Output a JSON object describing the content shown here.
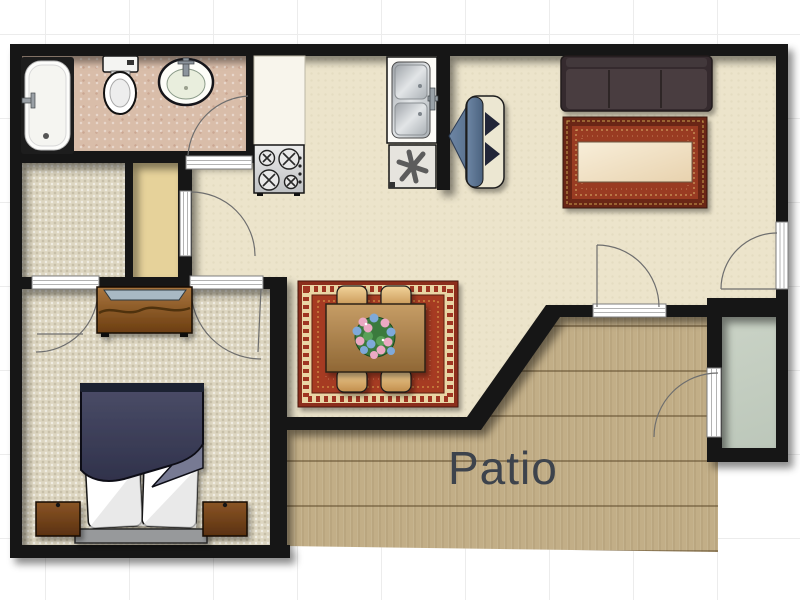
{
  "title": "One-bedroom apartment floor plan",
  "labels": {
    "patio": "Patio"
  },
  "rooms": [
    {
      "name": "bathroom",
      "floor_color": "#d9bda9"
    },
    {
      "name": "walk-in-closet",
      "floor_color": "#ddd6c1"
    },
    {
      "name": "hall-closet",
      "floor_color": "#e6d29a"
    },
    {
      "name": "bedroom",
      "floor_color": "#ddd6c1"
    },
    {
      "name": "kitchen-dining-living",
      "floor_color": "#ece4cb"
    },
    {
      "name": "patio",
      "label": "Patio",
      "floor_color": "#c2ae87"
    },
    {
      "name": "storage-room",
      "floor_color": "#c7d0c3"
    }
  ],
  "furniture": [
    "bathtub",
    "toilet",
    "bathroom-sink",
    "kitchen-counter",
    "stove",
    "kitchen-sink",
    "dishwasher",
    "armchair",
    "sofa",
    "living-room-rug",
    "coffee-table",
    "dining-rug",
    "dining-table",
    "dining-chairs",
    "flower-centerpiece",
    "dresser",
    "bed",
    "pillows",
    "nightstands"
  ],
  "doors": 7,
  "colors": {
    "wall": "#171615",
    "sofa": "#4a3e40",
    "rug_red": "#a23a22",
    "comforter_navy": "#44465f",
    "patio_wood": "#c2ae87",
    "label_text": "#3d434c"
  }
}
